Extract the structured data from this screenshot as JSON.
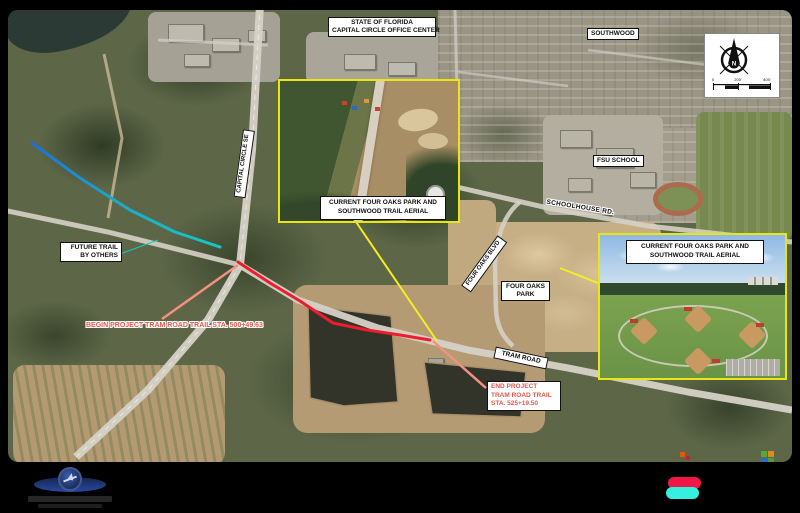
{
  "map": {
    "office_center_label": {
      "line1": "STATE OF FLORIDA",
      "line2": "CAPITAL CIRCLE OFFICE CENTER"
    },
    "southwood_label": "SOUTHWOOD",
    "fsu_school_label": "FSU SCHOOL",
    "four_oaks_park_label": {
      "line1": "FOUR OAKS",
      "line2": "PARK"
    },
    "roads": {
      "capital_circle_se": "CAPITAL CIRCLE SE",
      "schoolhouse_rd": "SCHOOLHOUSE RD.",
      "four_oaks_blvd": "FOUR OAKS BLVD",
      "tram_road": "TRAM ROAD"
    },
    "callouts": {
      "future_trail": {
        "line1": "FUTURE TRAIL",
        "line2": "BY OTHERS"
      },
      "begin_project": {
        "line1": "BEGIN PROJECT",
        "line2": "TRAM ROAD TRAIL",
        "line3": "STA. 500+49.63"
      },
      "end_project": {
        "line1": "END PROJECT",
        "line2": "TRAM ROAD TRAIL",
        "line3": "STA. 525+19.50"
      }
    },
    "inset_left_caption": {
      "line1": "CURRENT FOUR OAKS PARK AND",
      "line2": "SOUTHWOOD TRAIL AERIAL"
    },
    "inset_right_caption": {
      "line1": "CURRENT FOUR OAKS PARK AND",
      "line2": "SOUTHWOOD TRAIL AERIAL"
    },
    "compass": {
      "north_label": "N",
      "scale": {
        "t0": "0",
        "t1": "200'",
        "t2": "400'"
      }
    },
    "colors": {
      "future_trail_start": "#1d6ed8",
      "future_trail_end": "#16c9c2",
      "project_trail_red": "#ee1c2e",
      "leader_yellow": "#f6ee20",
      "leader_salmon": "#f29181",
      "callout_red_text": "#e8564b",
      "inset_border_yellow": "#e8e615",
      "badge_top_red": "#f01648",
      "badge_bottom_cyan": "#35f0df",
      "logo_navy": "#1d2f6b"
    }
  }
}
